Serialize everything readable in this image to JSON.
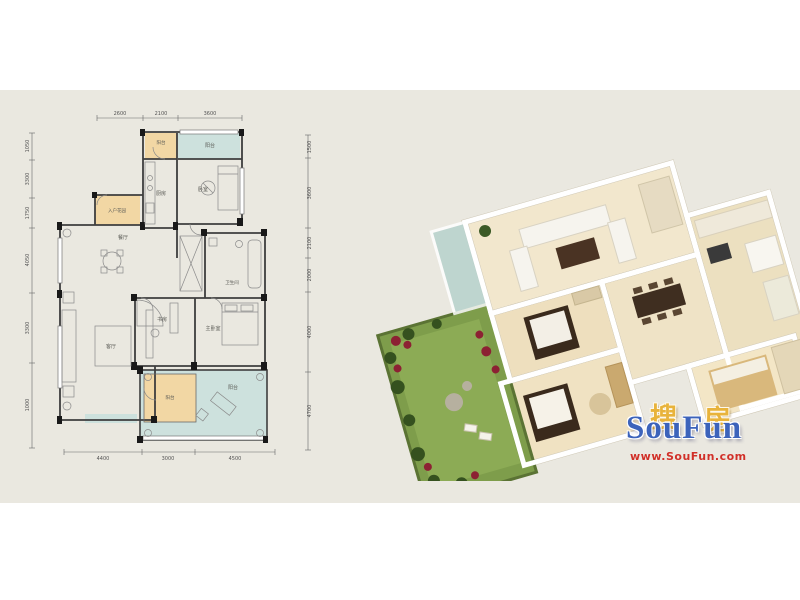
{
  "page": {
    "bg": "#ffffff",
    "band_bg": "#eae8e0"
  },
  "plan2d": {
    "colors": {
      "orange": "#f2d7a4",
      "teal": "#cde1dd",
      "wall": "#3e3e3e",
      "green_accent": "#7e9d4b"
    },
    "dims_top": [
      "2600",
      "2100",
      "3600"
    ],
    "dims_bottom": [
      "4400",
      "3000",
      "4500"
    ],
    "dims_left": [
      "1050",
      "3300",
      "1750",
      "4050",
      "3300",
      "1000"
    ],
    "dims_right": [
      "1500",
      "3600",
      "2100",
      "2000",
      "4000",
      "4700"
    ],
    "rooms": {
      "balcony_service": "阳台",
      "balcony_top": "阳台",
      "kitchen": "厨房",
      "bedroom": "卧室",
      "entry_garden": "入户花园",
      "dining": "餐厅",
      "bath": "卫生间",
      "master": "主卧室",
      "study": "书房",
      "living": "客厅",
      "balcony_small": "阳台",
      "balcony_large": "阳台"
    }
  },
  "watermark": {
    "cn_1": "搜",
    "cn_2": "房",
    "en": "SouFun",
    "url": "www.SouFun.com",
    "cn_color": "#e8b33b",
    "en_color": "#3c63bb",
    "url_color": "#d03028"
  }
}
